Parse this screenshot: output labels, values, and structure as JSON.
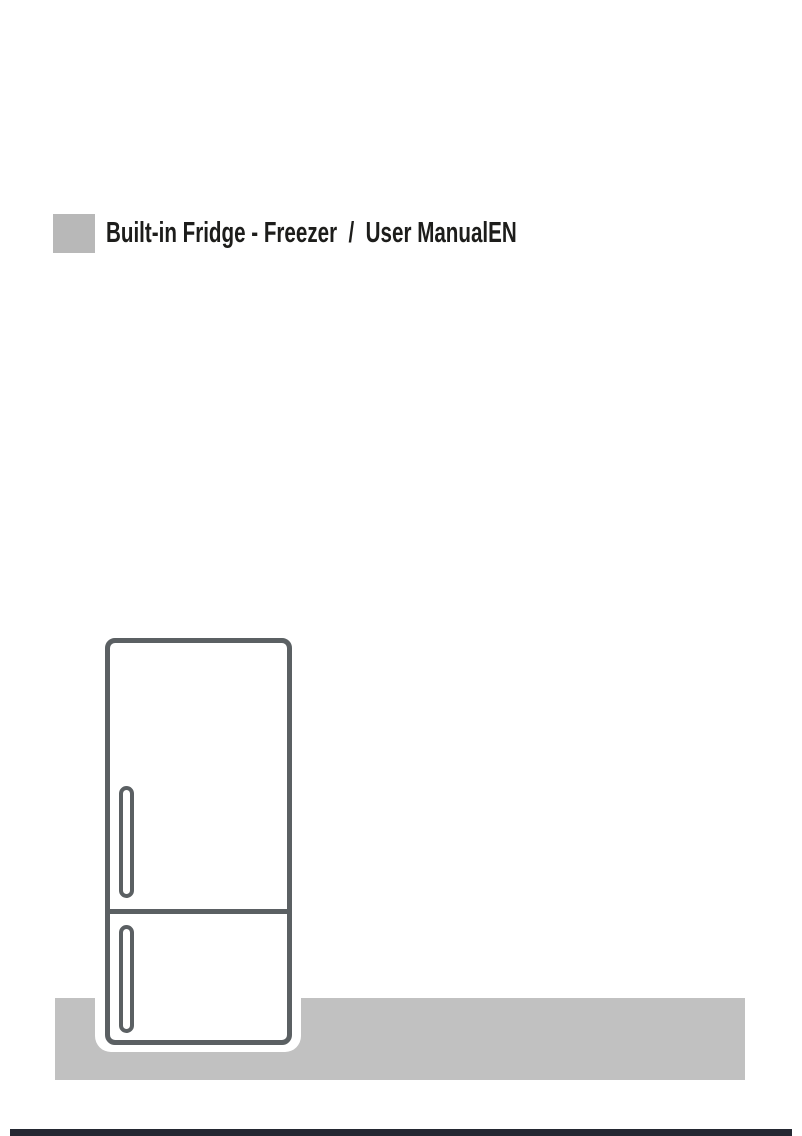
{
  "page": {
    "type": "user-manual-cover-page"
  },
  "header": {
    "title": "Built-in Fridge - Freezer  /  User ManualEN"
  },
  "illustration": {
    "icon": "fridge-freezer-two-door-outline-icon"
  },
  "colors": {
    "page-bg": "#ffffff",
    "title-text": "#1d1d1b",
    "marker-gray": "#b8b8b8",
    "floor-gray": "#c1c1c1",
    "fridge-outline": "#5b6063",
    "footer-bar": "#242832"
  }
}
